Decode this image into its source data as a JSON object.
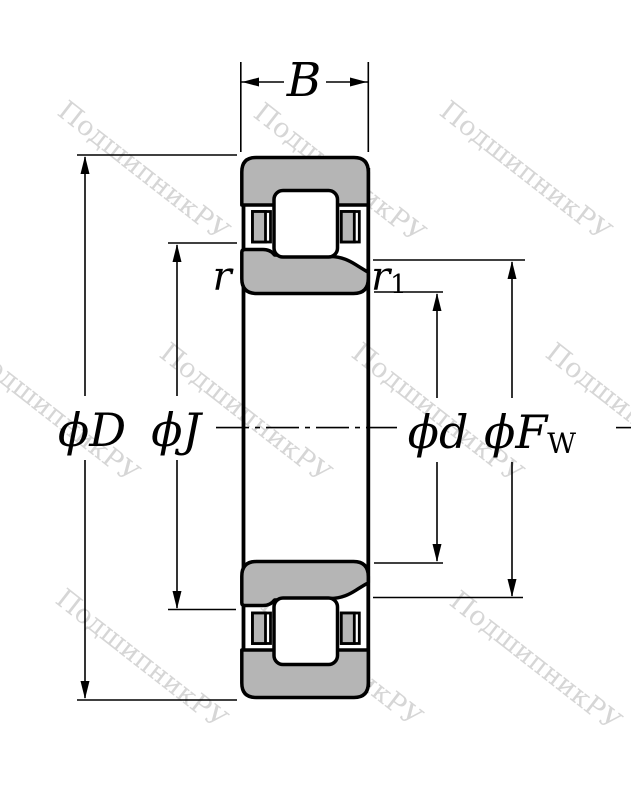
{
  "watermark": {
    "text": "ПодшипникРУ",
    "color": "#d6d6d6"
  },
  "drawing": {
    "ring_fill": "#b5b5b5",
    "line_color": "#000000",
    "background": "#ffffff"
  },
  "dimensions": {
    "width": {
      "label": "B"
    },
    "outer_diameter": {
      "label": "ϕD"
    },
    "rib_diameter": {
      "label": "ϕJ"
    },
    "bore_diameter": {
      "label": "ϕd"
    },
    "raceway_diameter": {
      "label": "ϕF",
      "subscript": "W"
    },
    "chamfer_outer": {
      "label": "r"
    },
    "chamfer_inner": {
      "label": "r",
      "subscript": "1"
    }
  }
}
